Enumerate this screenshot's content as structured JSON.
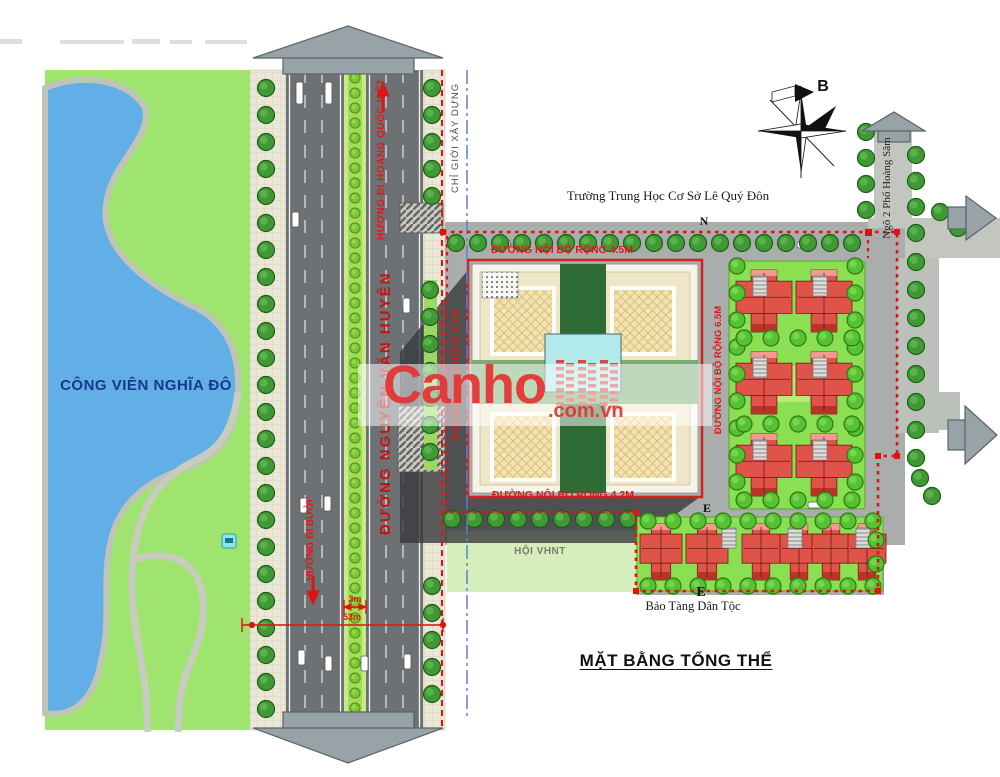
{
  "title": "MẶT BẰNG TỔNG THỂ",
  "watermark": {
    "brand": "Canho",
    "suffix": ".com.vn"
  },
  "compass": {
    "north_label": "B"
  },
  "park": {
    "name": "CÔNG VIÊN NGHĨA ĐÔ"
  },
  "labels": {
    "school": "Trường Trung Học Cơ Sở Lê Quý Đôn",
    "museum": "Bảo Tàng Dân Tộc",
    "culture_house": "HỘI VHNT",
    "marker_n": "N",
    "marker_e_top": "E",
    "marker_e_bottom": "E"
  },
  "roads": {
    "main_name": "ĐƯỜNG NGUYỄN VĂN HUYÊN",
    "dir_north": "HƯỚNG ĐI HOÀNG QUỐC VIỆT",
    "dir_south": "HƯỚNG ĐI BƯỞI",
    "construction_boundary": "CHỈ GIỚI XÂY DỰNG",
    "internal_top": "ĐƯỜNG NỘI BỘ RỘNG 4.5M",
    "internal_bottom": "ĐƯỜNG NỘI BỘ RỘNG 4.2M",
    "internal_west": "ĐƯỜNG NỘI BỘ RỘNG 4.7M",
    "internal_east": "ĐƯỜNG NỘI BỘ RỘNG 6.5M",
    "alley": "Ngõ 2 Phố Hoàng Sâm"
  },
  "dimensions": {
    "median_width": "3m",
    "road_total_width": "53m"
  },
  "colors": {
    "boundary_red": "#e01212",
    "construction_blue": "#5b7fd4",
    "park_green": "#9fe46e",
    "lake_blue": "#62aee6",
    "roof_red": "#df5348",
    "road_gray": "#6e7173",
    "watermark_red": "#e43636"
  }
}
